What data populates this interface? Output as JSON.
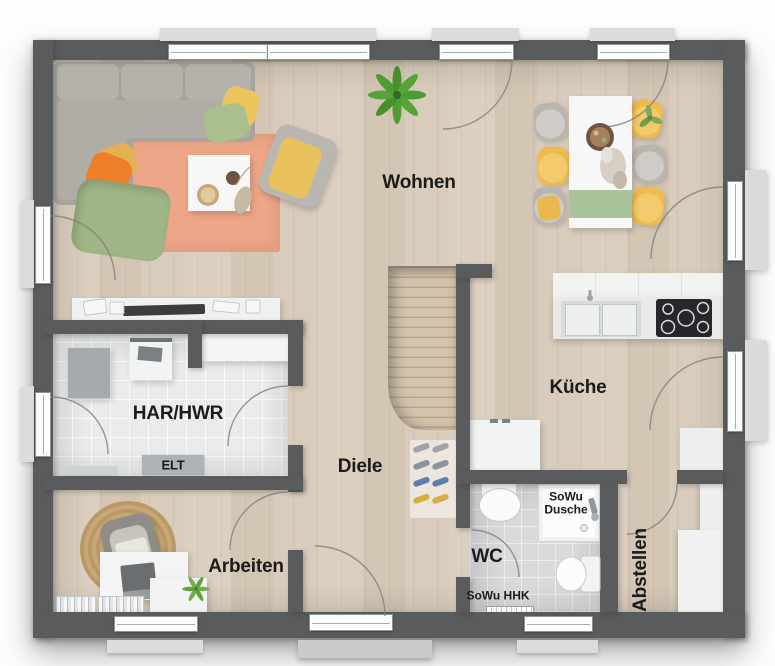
{
  "rooms": {
    "wohnen": "Wohnen",
    "kueche": "Küche",
    "har_hwr": "HAR/HWR",
    "diele": "Diele",
    "arbeiten": "Arbeiten",
    "wc": "WC",
    "abstellen": "Abstellen"
  },
  "annotations": {
    "elt": "ELT",
    "sowu_dusche_line1": "SoWu",
    "sowu_dusche_line2": "Dusche",
    "sowu_hhk": "SoWu HHK"
  },
  "colors": {
    "wall": "#595b5d",
    "floor_wood": "#d8cbbb",
    "floor_tile_light": "#e9ebec",
    "floor_tile_gray": "#d8dadc",
    "rug": "#eda687",
    "sofa_gray": "#a7a39d",
    "accent_yellow": "#efba4e",
    "accent_orange": "#ec7f28",
    "accent_green": "#a9c39b",
    "plant_green": "#4f9c33",
    "window_white": "#fcfdfd"
  }
}
